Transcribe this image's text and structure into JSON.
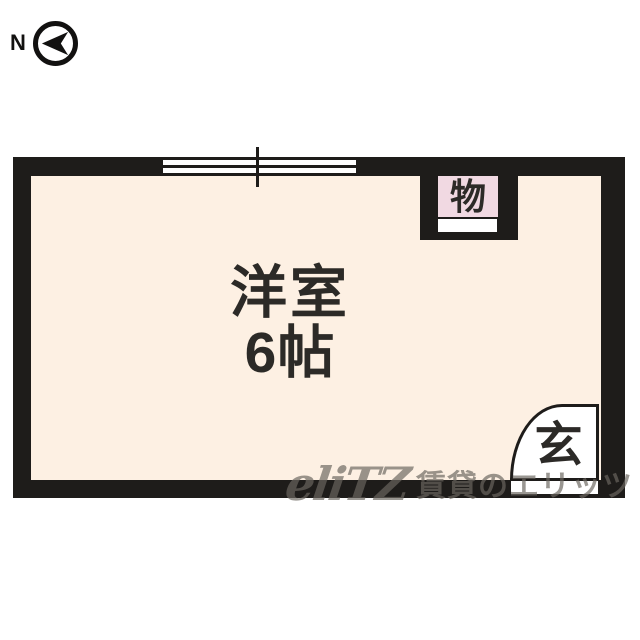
{
  "colors": {
    "page-bg": "#ffffff",
    "wall": "#1e1c1a",
    "room-fill": "#fdf0e3",
    "closet-fill": "#f1d9e2",
    "ink": "#2c2a27",
    "watermark": "#6b6660"
  },
  "compass": {
    "north_label": "N"
  },
  "floorplan": {
    "room_name": "洋室",
    "room_size": "6帖",
    "closet_label": "物",
    "entrance_label": "玄"
  },
  "watermark": {
    "logo": "eliTZ",
    "text": "賃貸のエリッツ"
  }
}
